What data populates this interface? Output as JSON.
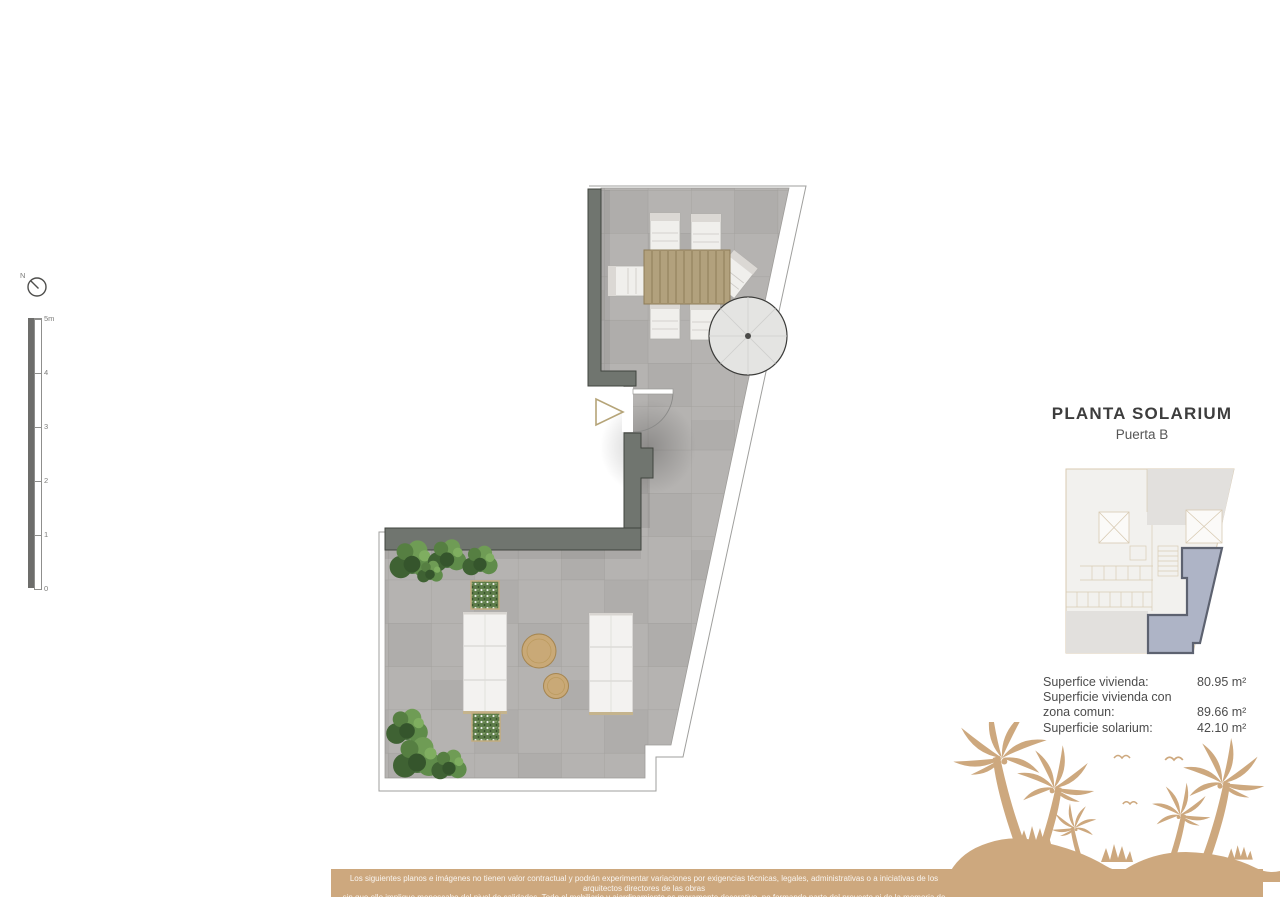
{
  "north_indicator": {
    "label": "N"
  },
  "scale_bar": {
    "tick_labels": [
      "5m",
      "4",
      "3",
      "2",
      "1",
      "0"
    ]
  },
  "title_block": {
    "title": "PLANTA SOLARIUM",
    "subtitle": "Puerta B"
  },
  "areas": {
    "rows": [
      {
        "label": "Superfice vivienda:",
        "value": "80.95 m²"
      },
      {
        "label": "Superficie vivienda con",
        "value": ""
      },
      {
        "label": "zona comun:",
        "value": "89.66 m²"
      },
      {
        "label": "Superficie solarium:",
        "value": "42.10 m²"
      }
    ]
  },
  "floor_plan": {
    "elements": [
      "terrace-tiles",
      "perimeter-walls",
      "entrance-door",
      "entrance-arrow",
      "dining-table",
      "dining-chairs",
      "parasol",
      "sofas",
      "coffee-tables",
      "planter-boxes",
      "shrubs"
    ]
  },
  "key_plan": {
    "description": "building-location-keyplan",
    "highlighted_unit": "Puerta B solarium"
  },
  "footer": {
    "disclaimer_line1": "Los siguientes planos e imágenes no tienen valor contractual y podrán experimentar variaciones por exigencias técnicas, legales, administrativas o a iniciativas de los arquitectos directores de las obras",
    "disclaimer_line2": "sin que ello implique menoscabo del nivel de calidades. Todo el mobiliario y ajardinamiento es meramente decorativo, no formando parte del proyecto ni de la memoria de calidades del proyecto."
  },
  "colors": {
    "tan_accent": "#cda87e",
    "wall_gray": "#70756f",
    "tile_gray": "#b5b3b1",
    "unit_highlight": "#aeb4c6"
  }
}
